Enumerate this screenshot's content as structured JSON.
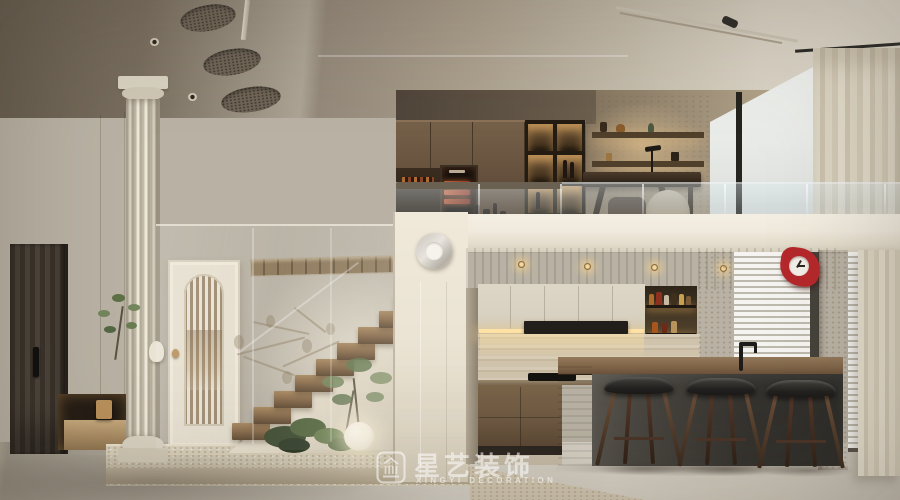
{
  "watermark": {
    "brand_cn": "星艺装饰",
    "brand_en": "XINGYI DECORATION",
    "icon": "classical-building-icon"
  },
  "palette": {
    "ceiling-dark": "#6b6052",
    "ceiling-light": "#d8d1c3",
    "wall-left": "#9c9180",
    "wall-stair": "#d3c9b6",
    "plaster-bright": "#ece4d3",
    "block-wall": "#ebe4d4",
    "fascia": "#f0eadd",
    "floor": "#cdc7ba",
    "travertine": "#d8cfba",
    "wood-soffit": "#5b4631",
    "wood-cabinet": "#6e5942",
    "wood-tread": "#997a58",
    "cream-cabinet": "#d8d1c1",
    "stone-loft": "#b7a88f",
    "island-top": "#7f6448",
    "island-front": "#3e3b36",
    "stool-seat": "#262522",
    "stool-leg": "#5d4533",
    "door-dark": "#423a30",
    "door-cream": "#e6dfcf",
    "brass": "#b9905a",
    "led-warm": "#f5d9a0",
    "glass-tint": "rgba(198,214,222,0.30)",
    "curtain": "#ddd5c3",
    "blinds": "#efede7",
    "window-sky": "#e9ebe8",
    "accent-red": "#b5282b",
    "green-dark": "#45533a",
    "green-light": "#74875c",
    "sphere-lamp": "#f7f0dd",
    "watermark-white": "rgba(255,255,255,0.55)"
  }
}
